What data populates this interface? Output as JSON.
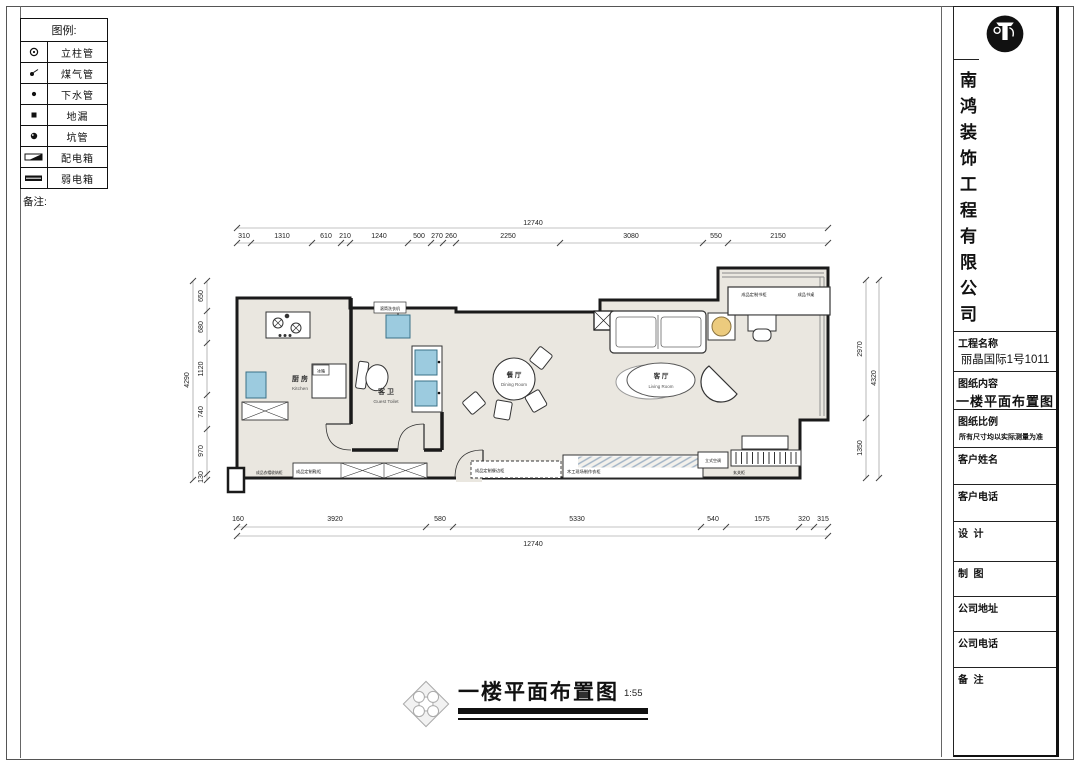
{
  "legend": {
    "title": "图例:",
    "items": [
      {
        "icon": "post-pipe-icon",
        "label": "立柱管"
      },
      {
        "icon": "gas-pipe-icon",
        "label": "煤气管"
      },
      {
        "icon": "drain-pipe-icon",
        "label": "下水管"
      },
      {
        "icon": "floor-drain-icon",
        "label": "地漏"
      },
      {
        "icon": "pit-pipe-icon",
        "label": "坑管"
      },
      {
        "icon": "power-box-icon",
        "label": "配电箱"
      },
      {
        "icon": "lv-box-icon",
        "label": "弱电箱"
      }
    ],
    "notes_label": "备注:"
  },
  "title_block": {
    "company_name": "南鸿装饰工程有限公司",
    "project_label": "工程名称",
    "project_value": "丽晶国际1号1011",
    "content_label": "图纸内容",
    "content_value": "一楼平面布置图",
    "scale_label": "图纸比例",
    "scale_note": "所有尺寸均以实际测量为准",
    "client_name_label": "客户姓名",
    "client_phone_label": "客户电话",
    "design_label": "设  计",
    "draft_label": "制  图",
    "company_addr_label": "公司地址",
    "company_phone_label": "公司电话",
    "remark_label": "备  注"
  },
  "drawing_title": {
    "text": "一楼平面布置图",
    "scale": "1:55"
  },
  "plan": {
    "rooms": {
      "kitchen": {
        "cn": "厨 房",
        "en": "Kitchen"
      },
      "guest_toilet": {
        "cn": "客 卫",
        "en": "Guest Toilet"
      },
      "dining": {
        "cn": "餐 厅",
        "en": "Dining Room"
      },
      "living": {
        "cn": "客 厅",
        "en": "Living Room"
      }
    },
    "labels": {
      "washer": "滚筒洗衣机",
      "fridge": "冰箱",
      "bookcase": "成品定制书柜",
      "desk": "成品书桌",
      "storage": "成品衣帽收纳柜",
      "shoe_cabinet": "成品定制鞋柜",
      "sideboard": "成品定制餐边柜",
      "wardrobe": "木工现场制作衣柜",
      "ac": "立式空调",
      "entry_cabinet": "玄关柜"
    }
  },
  "dimensions": {
    "top_total": "12740",
    "top": [
      "310",
      "1310",
      "610",
      "210",
      "1240",
      "500",
      "270",
      "260",
      "2250",
      "3080",
      "550",
      "2150"
    ],
    "bottom": [
      "160",
      "3920",
      "580",
      "5330",
      "540",
      "1575",
      "320",
      "315"
    ],
    "bottom_total": "12740",
    "left_total": "4290",
    "left": [
      "650",
      "680",
      "1120",
      "740",
      "970",
      "130"
    ],
    "right": [
      "2970",
      "1350"
    ],
    "right_total": "4320"
  },
  "colors": {
    "wall": "#1a1a1a",
    "floor": "#eae7e0",
    "appliance_blue": "#9ccbdf",
    "table_yellow": "#eccb7e"
  }
}
